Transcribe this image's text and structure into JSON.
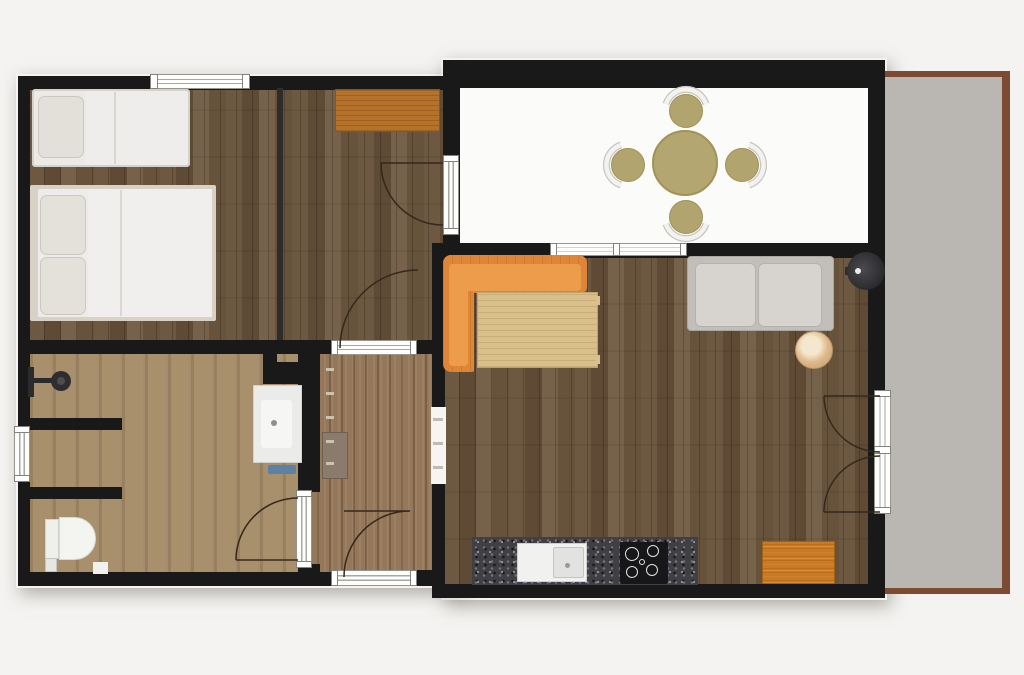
{
  "meta": {
    "title": "apartment-floor-plan",
    "canvas_w": 1024,
    "canvas_h": 675,
    "background": "#f4f3f1"
  },
  "palette": {
    "wall": "#19191a",
    "wood_floor": "#6a563f",
    "bath_floor": "#a8906d",
    "entry_floor": "#95775a",
    "patio_floor": "#fbfbfa",
    "terrace_fill": "#bab7b3",
    "terrace_border": "#7d4b32",
    "sofa_orange": "#df8537",
    "desk_orange": "#b5722a",
    "khaki": "#b2a46f",
    "counter_granite": "#3f3f44",
    "white_furniture": "#eceae7"
  },
  "rects": [
    {
      "name": "left-block-shadow",
      "x": 16,
      "y": 74,
      "w": 446,
      "h": 514,
      "cls": "shadow"
    },
    {
      "name": "right-block-shadow",
      "x": 441,
      "y": 58,
      "w": 446,
      "h": 542,
      "cls": "shadow"
    },
    {
      "name": "terrace-border",
      "x": 883,
      "y": 71,
      "w": 127,
      "h": 523,
      "fill": "#7d4b32"
    },
    {
      "name": "terrace-floor",
      "x": 883,
      "y": 77,
      "w": 119,
      "h": 511,
      "fill": "#bab7b3"
    },
    {
      "name": "bedroom-floor",
      "x": 28,
      "y": 86,
      "w": 418,
      "h": 260,
      "cls": "wood"
    },
    {
      "name": "bathroom-floor",
      "x": 28,
      "y": 350,
      "w": 277,
      "h": 226,
      "cls": "bath"
    },
    {
      "name": "entry-floor",
      "x": 305,
      "y": 350,
      "w": 130,
      "h": 226,
      "cls": "entry"
    },
    {
      "name": "living-kitchen-floor",
      "x": 443,
      "y": 252,
      "w": 438,
      "h": 335,
      "cls": "wood"
    },
    {
      "name": "patio-floor",
      "x": 458,
      "y": 86,
      "w": 412,
      "h": 160,
      "fill": "#fbfbfa"
    },
    {
      "name": "wall-top-left-block",
      "x": 18,
      "y": 76,
      "w": 442,
      "h": 14,
      "fill": "#19191a"
    },
    {
      "name": "wall-left",
      "x": 18,
      "y": 76,
      "w": 12,
      "h": 510,
      "fill": "#19191a"
    },
    {
      "name": "wall-bottom-left-block",
      "x": 18,
      "y": 572,
      "w": 316,
      "h": 14,
      "fill": "#19191a"
    },
    {
      "name": "wall-entry-bottom-right",
      "x": 413,
      "y": 570,
      "w": 21,
      "h": 16,
      "fill": "#19191a"
    },
    {
      "name": "wall-bed-bath-divider",
      "x": 18,
      "y": 340,
      "w": 428,
      "h": 14,
      "fill": "#19191a"
    },
    {
      "name": "wall-bedroom-partition",
      "x": 277,
      "y": 88,
      "w": 6,
      "h": 252,
      "fill": "#2e2c29"
    },
    {
      "name": "wall-bath-a",
      "x": 28,
      "y": 418,
      "w": 94,
      "h": 12,
      "fill": "#19191a"
    },
    {
      "name": "wall-bath-b",
      "x": 18,
      "y": 487,
      "w": 104,
      "h": 12,
      "fill": "#19191a"
    },
    {
      "name": "wall-bath-niche-v",
      "x": 263,
      "y": 352,
      "w": 14,
      "h": 32,
      "fill": "#19191a"
    },
    {
      "name": "wall-bath-niche-h",
      "x": 277,
      "y": 362,
      "w": 35,
      "h": 22,
      "fill": "#19191a"
    },
    {
      "name": "wall-bath-entry-divider",
      "x": 298,
      "y": 352,
      "w": 22,
      "h": 140,
      "fill": "#19191a"
    },
    {
      "name": "wall-entry-corner",
      "x": 298,
      "y": 564,
      "w": 22,
      "h": 20,
      "fill": "#19191a"
    },
    {
      "name": "wall-living-left",
      "x": 432,
      "y": 243,
      "w": 13,
      "h": 355,
      "fill": "#19191a"
    },
    {
      "name": "wall-desk-patio",
      "x": 443,
      "y": 86,
      "w": 17,
      "h": 164,
      "fill": "#19191a"
    },
    {
      "name": "wall-patio-top",
      "x": 443,
      "y": 60,
      "w": 442,
      "h": 28,
      "fill": "#19191a"
    },
    {
      "name": "wall-patio-living-divider",
      "x": 432,
      "y": 243,
      "w": 453,
      "h": 15,
      "fill": "#19191a"
    },
    {
      "name": "wall-right",
      "x": 868,
      "y": 60,
      "w": 17,
      "h": 532,
      "fill": "#19191a"
    },
    {
      "name": "wall-bottom-right-block",
      "x": 432,
      "y": 584,
      "w": 453,
      "h": 14,
      "fill": "#19191a"
    },
    {
      "name": "window-bedroom",
      "x": 150,
      "y": 74,
      "w": 100,
      "h": 15,
      "cls": "wlh"
    },
    {
      "name": "window-bedroom-cap-left",
      "x": 150,
      "y": 74,
      "w": 8,
      "h": 15,
      "cls": "wcap"
    },
    {
      "name": "window-bedroom-cap-right",
      "x": 242,
      "y": 74,
      "w": 8,
      "h": 15,
      "cls": "wcap"
    },
    {
      "name": "window-living",
      "x": 550,
      "y": 243,
      "w": 137,
      "h": 13,
      "cls": "wlh"
    },
    {
      "name": "window-living-cap-left",
      "x": 550,
      "y": 243,
      "w": 7,
      "h": 13,
      "cls": "wcap"
    },
    {
      "name": "window-living-cap-mid",
      "x": 613,
      "y": 243,
      "w": 7,
      "h": 13,
      "cls": "wcap"
    },
    {
      "name": "window-living-cap-right",
      "x": 680,
      "y": 243,
      "w": 7,
      "h": 13,
      "cls": "wcap"
    },
    {
      "name": "window-bath",
      "x": 14,
      "y": 426,
      "w": 16,
      "h": 56,
      "cls": "wlv"
    },
    {
      "name": "window-bath-cap-top",
      "x": 14,
      "y": 426,
      "w": 16,
      "h": 7,
      "cls": "wcap"
    },
    {
      "name": "window-bath-cap-bottom",
      "x": 14,
      "y": 475,
      "w": 16,
      "h": 7,
      "cls": "wcap"
    },
    {
      "name": "frame-entry-top",
      "x": 331,
      "y": 340,
      "w": 86,
      "h": 15,
      "cls": "wlh"
    },
    {
      "name": "frame-entry-top-cap-left",
      "x": 331,
      "y": 340,
      "w": 7,
      "h": 15,
      "cls": "wcap"
    },
    {
      "name": "frame-entry-top-cap-right",
      "x": 410,
      "y": 340,
      "w": 7,
      "h": 15,
      "cls": "wcap"
    },
    {
      "name": "frame-entry-bottom",
      "x": 331,
      "y": 570,
      "w": 86,
      "h": 16,
      "cls": "wlh"
    },
    {
      "name": "frame-entry-bottom-cap-left",
      "x": 331,
      "y": 570,
      "w": 7,
      "h": 16,
      "cls": "wcap"
    },
    {
      "name": "frame-entry-bottom-cap-right",
      "x": 410,
      "y": 570,
      "w": 7,
      "h": 16,
      "cls": "wcap"
    },
    {
      "name": "door-frame-bath",
      "x": 296,
      "y": 490,
      "w": 16,
      "h": 78,
      "cls": "wlv"
    },
    {
      "name": "door-frame-bath-cap-top",
      "x": 296,
      "y": 490,
      "w": 16,
      "h": 7,
      "cls": "wcap"
    },
    {
      "name": "door-frame-bath-cap-bottom",
      "x": 296,
      "y": 561,
      "w": 16,
      "h": 7,
      "cls": "wcap"
    },
    {
      "name": "door-frame-desk-patio",
      "x": 443,
      "y": 155,
      "w": 16,
      "h": 80,
      "cls": "wlv"
    },
    {
      "name": "door-frame-desk-patio-cap-top",
      "x": 443,
      "y": 155,
      "w": 16,
      "h": 7,
      "cls": "wcap"
    },
    {
      "name": "door-frame-desk-patio-cap-bottom",
      "x": 443,
      "y": 228,
      "w": 16,
      "h": 7,
      "cls": "wcap"
    },
    {
      "name": "door-frame-terrace",
      "x": 874,
      "y": 390,
      "w": 17,
      "h": 124,
      "cls": "wlv"
    },
    {
      "name": "door-frame-terrace-cap-top",
      "x": 874,
      "y": 390,
      "w": 17,
      "h": 7,
      "cls": "wcap"
    },
    {
      "name": "door-frame-terrace-cap-mid",
      "x": 874,
      "y": 446,
      "w": 17,
      "h": 8,
      "cls": "wcap"
    },
    {
      "name": "door-frame-terrace-cap-bottom",
      "x": 874,
      "y": 507,
      "w": 17,
      "h": 7,
      "cls": "wcap"
    },
    {
      "name": "opening-entry-kitchen",
      "x": 431,
      "y": 407,
      "w": 15,
      "h": 77,
      "fill": "#f6f5f2"
    },
    {
      "name": "opening-dash-1",
      "x": 433,
      "y": 418,
      "w": 10,
      "h": 3,
      "fill": "#bfbab2"
    },
    {
      "name": "opening-dash-2",
      "x": 433,
      "y": 442,
      "w": 10,
      "h": 3,
      "fill": "#bfbab2"
    },
    {
      "name": "opening-dash-3",
      "x": 433,
      "y": 466,
      "w": 10,
      "h": 3,
      "fill": "#bfbab2"
    },
    {
      "name": "single-bed",
      "x": 32,
      "y": 89,
      "w": 158,
      "h": 78,
      "fill": "#eceae7",
      "border": "2px solid #d6d2ca",
      "radius": 3
    },
    {
      "name": "single-bed-duvet",
      "x": 86,
      "y": 91,
      "w": 102,
      "h": 74,
      "fill": "#efedeb",
      "radius": 3
    },
    {
      "name": "single-bed-duvet-fold",
      "x": 114,
      "y": 92,
      "w": 2,
      "h": 72,
      "fill": "#d9d5cf"
    },
    {
      "name": "single-bed-pillow",
      "x": 38,
      "y": 96,
      "w": 46,
      "h": 62,
      "fill": "#e3e0da",
      "border": "1px solid #ccc8c0",
      "radius": 7
    },
    {
      "name": "double-bed-frame",
      "x": 30,
      "y": 185,
      "w": 186,
      "h": 136,
      "fill": "#d8d2c6",
      "radius": 2
    },
    {
      "name": "double-bed-mattress",
      "x": 38,
      "y": 189,
      "w": 174,
      "h": 128,
      "fill": "#edecea",
      "radius": 2
    },
    {
      "name": "double-bed-duvet",
      "x": 88,
      "y": 189,
      "w": 124,
      "h": 128,
      "fill": "#f0efed"
    },
    {
      "name": "double-bed-duvet-fold",
      "x": 120,
      "y": 190,
      "w": 2,
      "h": 126,
      "fill": "#dad6d0"
    },
    {
      "name": "double-bed-pillow-top",
      "x": 40,
      "y": 195,
      "w": 46,
      "h": 60,
      "fill": "#e4e1db",
      "border": "1px solid #ccc8c0",
      "radius": 7
    },
    {
      "name": "double-bed-pillow-bottom",
      "x": 40,
      "y": 257,
      "w": 46,
      "h": 58,
      "fill": "#e4e1db",
      "border": "1px solid #ccc8c0",
      "radius": 7
    },
    {
      "name": "desk",
      "x": 335,
      "y": 89,
      "w": 105,
      "h": 43,
      "cls": "wood-orange"
    },
    {
      "name": "sofa-seat",
      "x": 443,
      "y": 255,
      "w": 144,
      "h": 38,
      "cls": "sofa",
      "radius": "8px 8px 6px 2px"
    },
    {
      "name": "sofa-chaise",
      "x": 443,
      "y": 255,
      "w": 31,
      "h": 117,
      "cls": "sofa",
      "radius": "8px 2px 2px 8px"
    },
    {
      "name": "sofa-seat-cushion",
      "x": 451,
      "y": 264,
      "w": 130,
      "h": 27,
      "fill": "#ec9c4a",
      "radius": 4
    },
    {
      "name": "sofa-chaise-cushion",
      "x": 449,
      "y": 264,
      "w": 19,
      "h": 102,
      "fill": "#ec9c4a",
      "radius": 4
    },
    {
      "name": "coffee-table",
      "x": 477,
      "y": 292,
      "w": 121,
      "h": 76,
      "cls": "table-wood",
      "border": "1px solid #bfa267"
    },
    {
      "name": "coffee-table-tab-top",
      "x": 596,
      "y": 296,
      "w": 4,
      "h": 9,
      "fill": "#d9c08c"
    },
    {
      "name": "coffee-table-tab-bottom",
      "x": 596,
      "y": 355,
      "w": 4,
      "h": 9,
      "fill": "#d9c08c"
    },
    {
      "name": "couch-base",
      "x": 687,
      "y": 256,
      "w": 147,
      "h": 75,
      "fill": "#c2beb9",
      "border": "1px solid #aaa6a1",
      "radius": 4
    },
    {
      "name": "couch-cushion-left",
      "x": 695,
      "y": 263,
      "w": 61,
      "h": 64,
      "fill": "#d7d4d0",
      "border": "1px solid #b5b1ac",
      "radius": 6
    },
    {
      "name": "couch-cushion-right",
      "x": 758,
      "y": 263,
      "w": 64,
      "h": 64,
      "fill": "#d7d4d0",
      "border": "1px solid #b5b1ac",
      "radius": 6
    },
    {
      "name": "lamp-arm",
      "x": 845,
      "y": 267,
      "w": 10,
      "h": 8,
      "fill": "#2c2c2e"
    },
    {
      "name": "kitchen-counter",
      "x": 472,
      "y": 537,
      "w": 226,
      "h": 48,
      "cls": "granite"
    },
    {
      "name": "kitchen-sink-unit",
      "x": 517,
      "y": 543,
      "w": 70,
      "h": 39,
      "fill": "#f1f1ef",
      "border": "1px solid #cfcfcc"
    },
    {
      "name": "kitchen-sink-basin",
      "x": 553,
      "y": 547,
      "w": 31,
      "h": 31,
      "fill": "#e2e2e0",
      "border": "1px solid #c4c4c1",
      "radius": 2
    },
    {
      "name": "cooktop",
      "x": 620,
      "y": 542,
      "w": 48,
      "h": 42,
      "fill": "#17171a",
      "radius": 2
    },
    {
      "name": "kitchen-mat",
      "x": 762,
      "y": 541,
      "w": 73,
      "h": 43,
      "cls": "wood-orange2"
    },
    {
      "name": "shower-rail",
      "x": 28,
      "y": 367,
      "w": 6,
      "h": 30,
      "fill": "#2b2b2d"
    },
    {
      "name": "shower-arm",
      "x": 34,
      "y": 378,
      "w": 22,
      "h": 5,
      "fill": "#2b2b2d"
    },
    {
      "name": "toilet-tank",
      "x": 45,
      "y": 519,
      "w": 14,
      "h": 40,
      "fill": "#efefec",
      "border": "1px solid #d2d2cf"
    },
    {
      "name": "toilet-bowl",
      "x": 59,
      "y": 517,
      "w": 37,
      "h": 43,
      "fill": "#f4f4f1",
      "border": "1px solid #d8d8d5",
      "radius": "0 22px 22px 0"
    },
    {
      "name": "bath-scale",
      "x": 45,
      "y": 558,
      "w": 12,
      "h": 14,
      "fill": "#e6e6e3",
      "border": "1px solid #c4c4c1"
    },
    {
      "name": "bath-step",
      "x": 93,
      "y": 562,
      "w": 15,
      "h": 12,
      "fill": "#f1f1ee"
    },
    {
      "name": "vanity",
      "x": 253,
      "y": 385,
      "w": 49,
      "h": 78,
      "fill": "#ebebe9",
      "border": "1px solid #d0d0cd"
    },
    {
      "name": "vanity-basin",
      "x": 261,
      "y": 400,
      "w": 31,
      "h": 48,
      "fill": "#f6f6f4",
      "border": "1px solid #cccccа",
      "radius": 3
    },
    {
      "name": "vanity-mat",
      "x": 268,
      "y": 465,
      "w": 28,
      "h": 9,
      "fill": "#5d80a5",
      "radius": 2
    },
    {
      "name": "sauna-bench",
      "x": 322,
      "y": 432,
      "w": 26,
      "h": 47,
      "fill": "#8b7b6d",
      "border": "1px solid #6f5f51"
    },
    {
      "name": "ladder-tick-1",
      "x": 326,
      "y": 368,
      "w": 8,
      "h": 3,
      "fill": "#cdc2ad"
    },
    {
      "name": "ladder-tick-2",
      "x": 326,
      "y": 392,
      "w": 8,
      "h": 3,
      "fill": "#cdc2ad"
    },
    {
      "name": "ladder-tick-3",
      "x": 326,
      "y": 416,
      "w": 8,
      "h": 3,
      "fill": "#cdc2ad"
    },
    {
      "name": "ladder-tick-4",
      "x": 326,
      "y": 440,
      "w": 8,
      "h": 3,
      "fill": "#cdc2ad"
    },
    {
      "name": "ladder-tick-5",
      "x": 326,
      "y": 462,
      "w": 8,
      "h": 3,
      "fill": "#cdc2ad"
    }
  ],
  "circles": [
    {
      "name": "dining-table",
      "cx": 685,
      "cy": 163,
      "r": 33,
      "fill": "#b3a671",
      "border": "2px solid #a29255"
    },
    {
      "name": "dining-stool-top",
      "cx": 686,
      "cy": 111,
      "r": 17,
      "fill": "#b2a46f",
      "border": "1px solid #a09152"
    },
    {
      "name": "dining-stool-left",
      "cx": 628,
      "cy": 165,
      "r": 17,
      "fill": "#b2a46f",
      "border": "1px solid #a09152"
    },
    {
      "name": "dining-stool-right",
      "cx": 742,
      "cy": 165,
      "r": 17,
      "fill": "#b2a46f",
      "border": "1px solid #a09152"
    },
    {
      "name": "dining-stool-bottom",
      "cx": 686,
      "cy": 217,
      "r": 17,
      "fill": "#b2a46f",
      "border": "1px solid #a09152"
    },
    {
      "name": "hanging-lamp",
      "cx": 866,
      "cy": 271,
      "r": 19,
      "cls": "lampc"
    },
    {
      "name": "hanging-lamp-dot",
      "cx": 858,
      "cy": 271,
      "r": 3,
      "fill": "#ececea"
    },
    {
      "name": "side-table",
      "cx": 814,
      "cy": 350,
      "r": 19,
      "cls": "marble",
      "border": "1px solid #bb9464"
    },
    {
      "name": "shower-head",
      "cx": 61,
      "cy": 381,
      "r": 10,
      "fill": "#2e2e30"
    },
    {
      "name": "shower-head-center",
      "cx": 61,
      "cy": 381,
      "r": 4,
      "fill": "#4d4d50"
    },
    {
      "name": "vanity-faucet",
      "cx": 274,
      "cy": 423,
      "r": 3,
      "fill": "#8e8e8c"
    },
    {
      "name": "sink-faucet",
      "cx": 567,
      "cy": 565,
      "r": 2.5,
      "fill": "#9a9a98"
    },
    {
      "name": "burner-1",
      "cx": 632,
      "cy": 554,
      "r": 7,
      "fill": "transparent",
      "border": "1.6px solid #e3e3e1"
    },
    {
      "name": "burner-2",
      "cx": 653,
      "cy": 551,
      "r": 6,
      "fill": "transparent",
      "border": "1.6px solid #e3e3e1"
    },
    {
      "name": "burner-3",
      "cx": 632,
      "cy": 572,
      "r": 6,
      "fill": "transparent",
      "border": "1.6px solid #e3e3e1"
    },
    {
      "name": "burner-4",
      "cx": 652,
      "cy": 570,
      "r": 6,
      "fill": "transparent",
      "border": "1.6px solid #e3e3e1"
    },
    {
      "name": "burner-center",
      "cx": 642,
      "cy": 562,
      "r": 3,
      "fill": "transparent",
      "border": "1.4px solid #e3e3e1"
    }
  ],
  "paths": [
    {
      "name": "door-arc-desk-patio",
      "d": "M 381 163 L 443 163 M 381 163 A 62 62 0 0 0 443 225",
      "stroke": "#35281b",
      "w": 1.5
    },
    {
      "name": "door-arc-desk-entry",
      "d": "M 340 348 A 78 78 0 0 1 418 270",
      "stroke": "#35281b",
      "w": 1.5
    },
    {
      "name": "door-arc-bath",
      "d": "M 236 560 L 298 560 M 236 560 A 62 62 0 0 1 298 498",
      "stroke": "#35281b",
      "w": 1.5
    },
    {
      "name": "door-arc-entry",
      "d": "M 344 511 L 410 511 M 344 577 A 66 66 0 0 1 410 511",
      "stroke": "#35281b",
      "w": 1.5
    },
    {
      "name": "door-arc-terrace-upper",
      "d": "M 824 396 L 880 396 M 824 396 A 56 56 0 0 0 880 452",
      "stroke": "#35281b",
      "w": 1.5
    },
    {
      "name": "door-arc-terrace-lower",
      "d": "M 824 512 L 880 512 M 824 512 A 56 56 0 0 1 880 456",
      "stroke": "#35281b",
      "w": 1.5
    },
    {
      "name": "stool-back-top-outline",
      "d": "M 666 104 A 21 21 0 0 1 706 104",
      "stroke": "#c6c6c2",
      "w": 7
    },
    {
      "name": "stool-back-top",
      "d": "M 666 104 A 21 21 0 0 1 706 104",
      "stroke": "#f3f2ef",
      "w": 4.5
    },
    {
      "name": "stool-back-left-outline",
      "d": "M 621 145 A 21 21 0 0 0 621 185",
      "stroke": "#c6c6c2",
      "w": 7
    },
    {
      "name": "stool-back-left",
      "d": "M 621 145 A 21 21 0 0 0 621 185",
      "stroke": "#f3f2ef",
      "w": 4.5
    },
    {
      "name": "stool-back-right-outline",
      "d": "M 749 145 A 21 21 0 0 1 749 185",
      "stroke": "#c6c6c2",
      "w": 7
    },
    {
      "name": "stool-back-right",
      "d": "M 749 145 A 21 21 0 0 1 749 185",
      "stroke": "#f3f2ef",
      "w": 4.5
    },
    {
      "name": "stool-back-bottom-outline",
      "d": "M 666 224 A 21 21 0 0 0 706 224",
      "stroke": "#c6c6c2",
      "w": 7
    },
    {
      "name": "stool-back-bottom",
      "d": "M 666 224 A 21 21 0 0 0 706 224",
      "stroke": "#f3f2ef",
      "w": 4.5
    }
  ]
}
